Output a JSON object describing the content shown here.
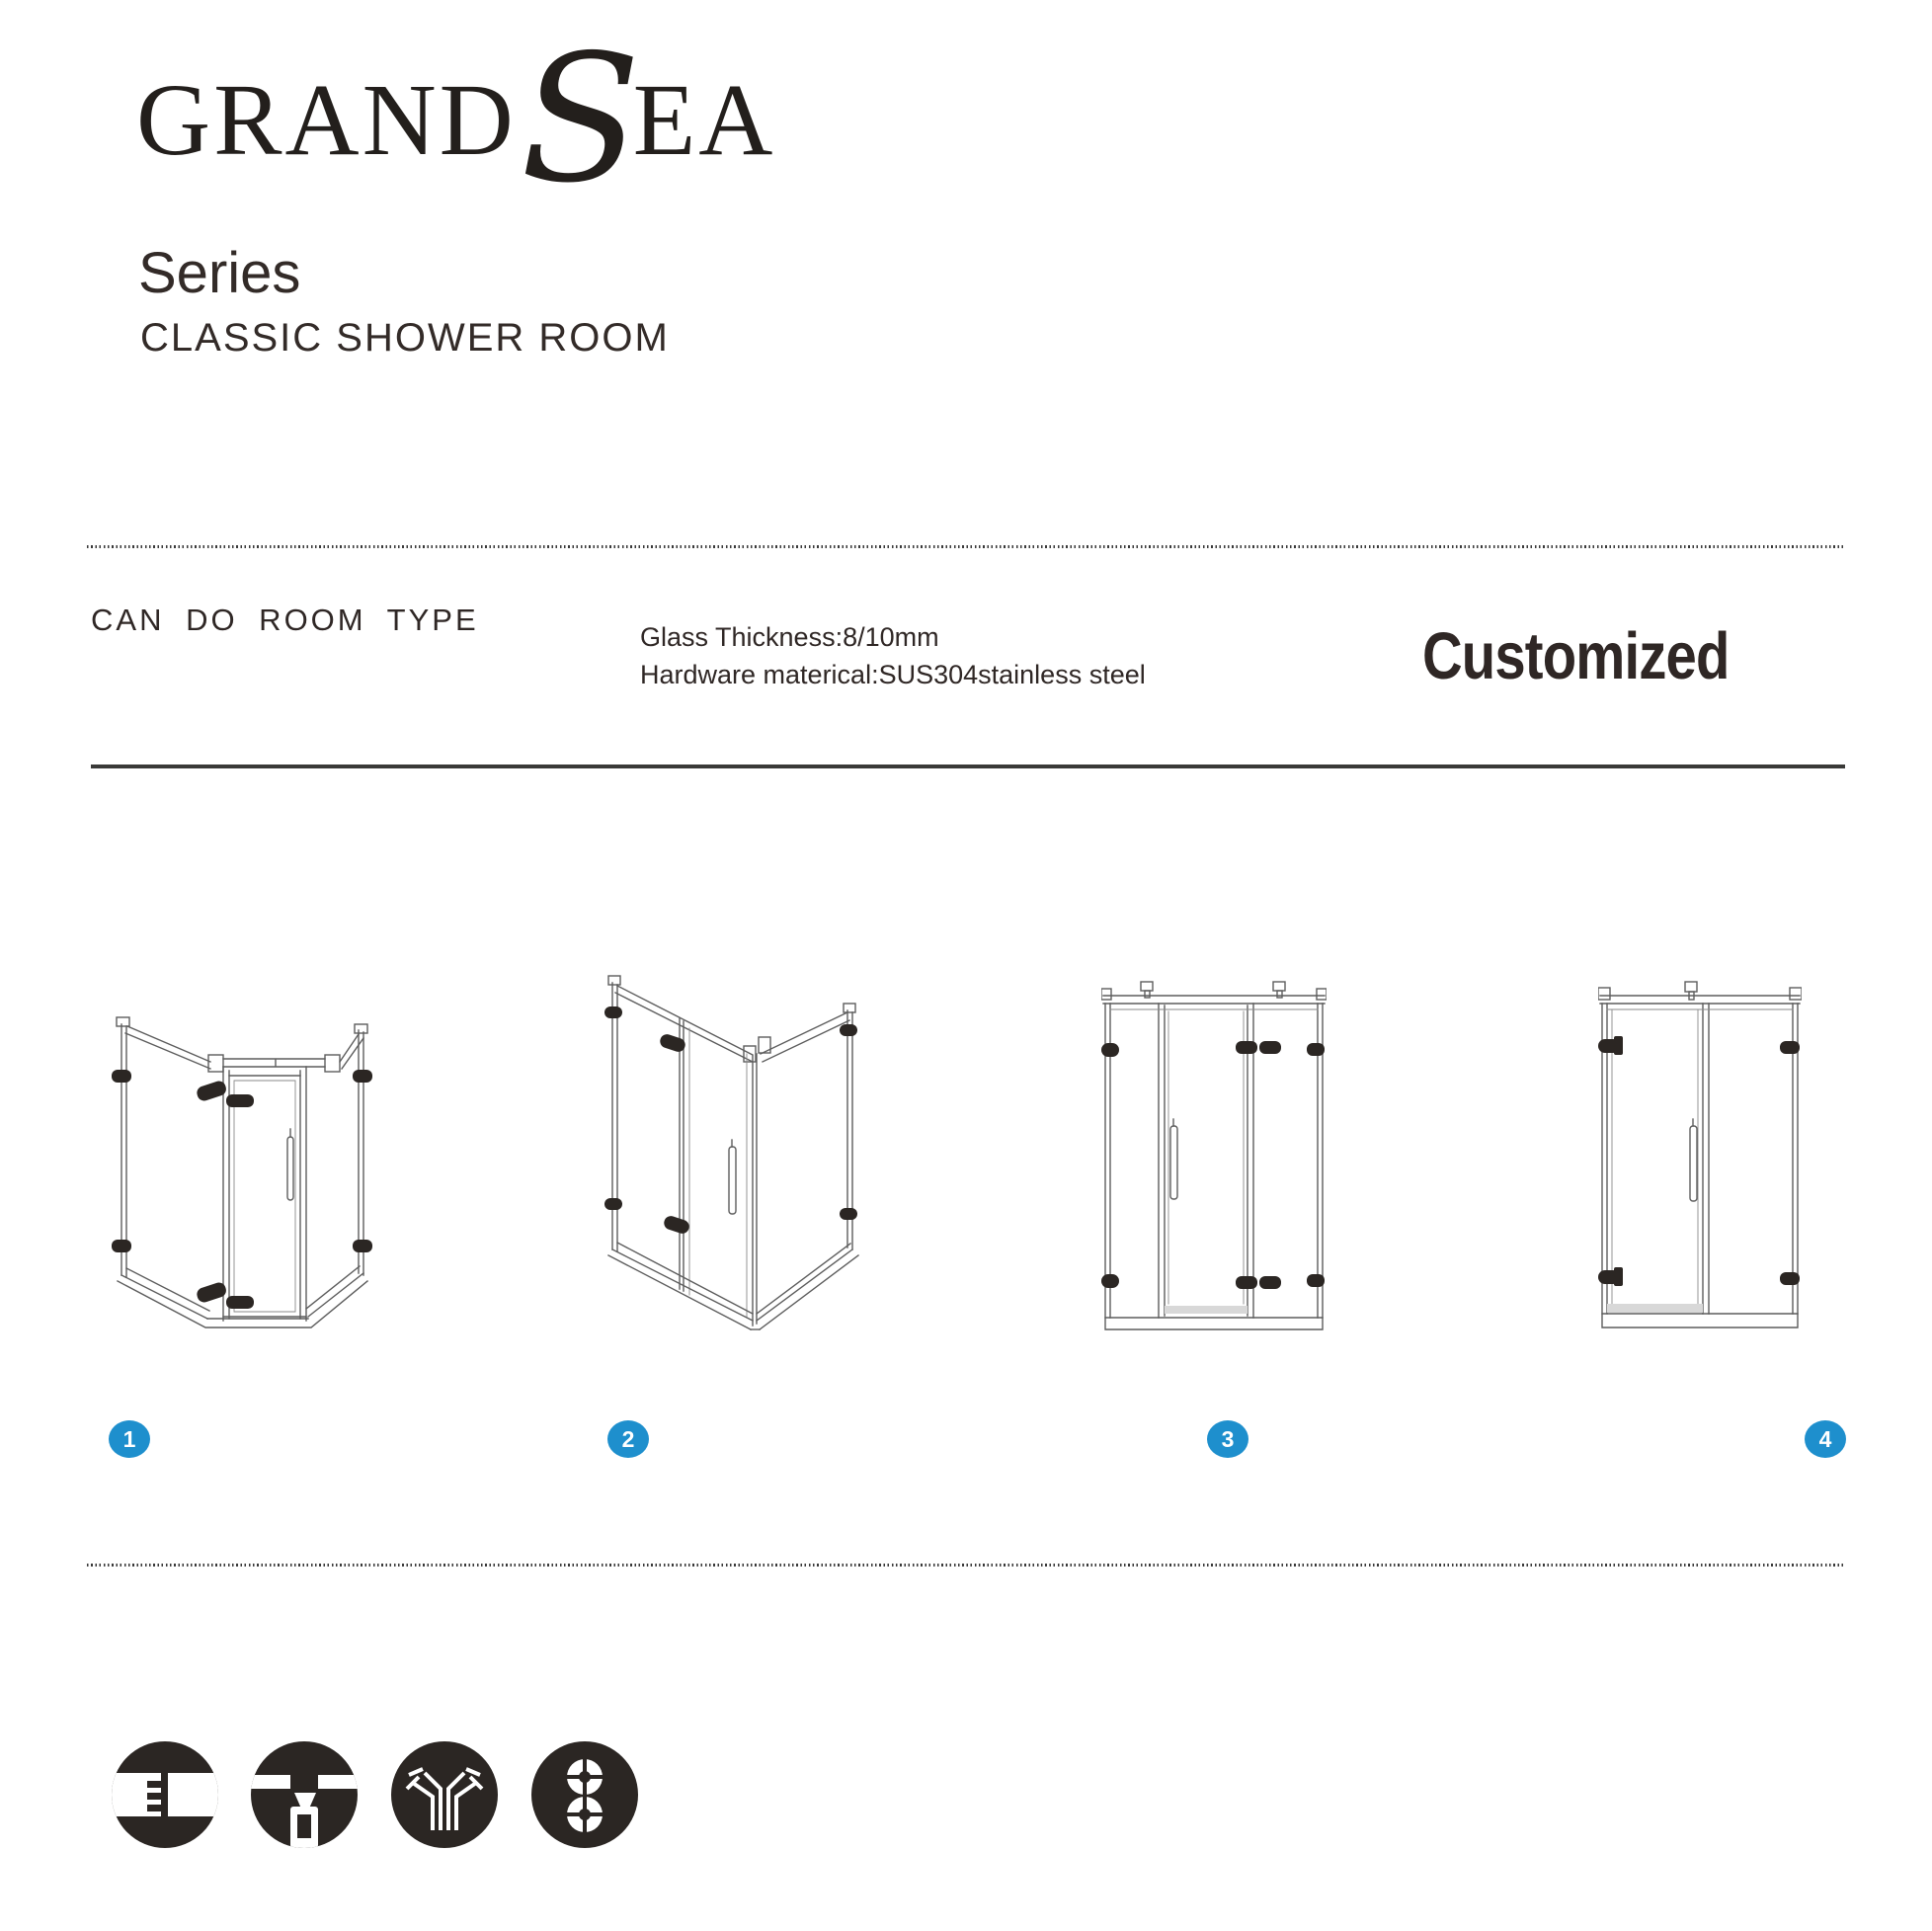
{
  "logo": {
    "grand": "GRAND",
    "s": "S",
    "ea": "EA"
  },
  "header": {
    "series_title": "Series",
    "series_subtitle": "CLASSIC SHOWER ROOM"
  },
  "specs": {
    "heading": "CAN DO ROOM TYPE",
    "glass_thickness": "Glass Thickness:8/10mm",
    "hardware_material": "Hardware materical:SUS304stainless steel",
    "customized": "Customized"
  },
  "room_types": [
    {
      "number": "1"
    },
    {
      "number": "2"
    },
    {
      "number": "3"
    },
    {
      "number": "4"
    }
  ],
  "icons": [
    {
      "name": "glass-joint-icon"
    },
    {
      "name": "support-bar-clamp-icon"
    },
    {
      "name": "corner-seal-icon"
    },
    {
      "name": "double-roller-icon"
    }
  ],
  "colors": {
    "accent_blue": "#1e8fcd",
    "ink": "#2f2725"
  }
}
